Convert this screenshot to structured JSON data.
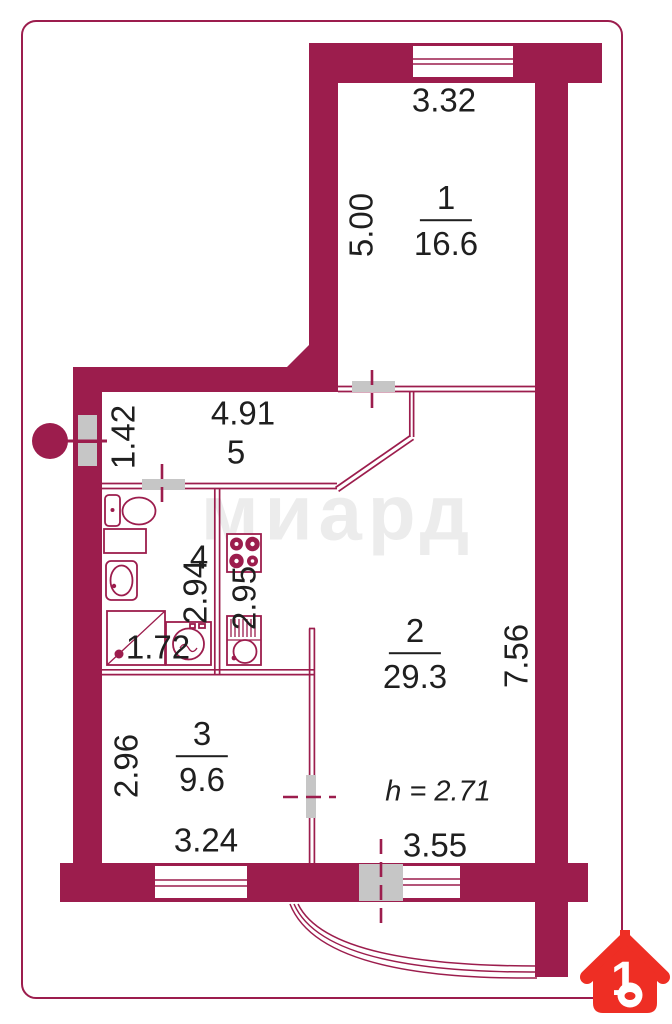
{
  "watermark": "миард",
  "logo": {
    "number": "1"
  },
  "ceiling": {
    "label": "h = 2.71"
  },
  "rooms": {
    "r1": {
      "number": "1",
      "area": "16.6"
    },
    "r2": {
      "number": "2",
      "area": "29.3"
    },
    "r3": {
      "number": "3",
      "area": "9.6"
    },
    "r4": {
      "number": "4"
    },
    "r5": {
      "number": "5"
    }
  },
  "dims": {
    "room1_width": "3.32",
    "room1_depth": "5.00",
    "hall_width": "4.91",
    "hall_depth": "1.42",
    "bath_depth": "2.94",
    "kitchen_depth": "2.95",
    "shower": "1.72",
    "room2_depth": "7.56",
    "room3_depth": "2.96",
    "room3_width": "3.24",
    "balcony_width": "3.55"
  },
  "colors": {
    "wall": "#9c1d4d",
    "door": "#c6c6c6",
    "logo_red": "#ee2e24",
    "text": "#1f1f1f",
    "watermark": "#ececec"
  }
}
